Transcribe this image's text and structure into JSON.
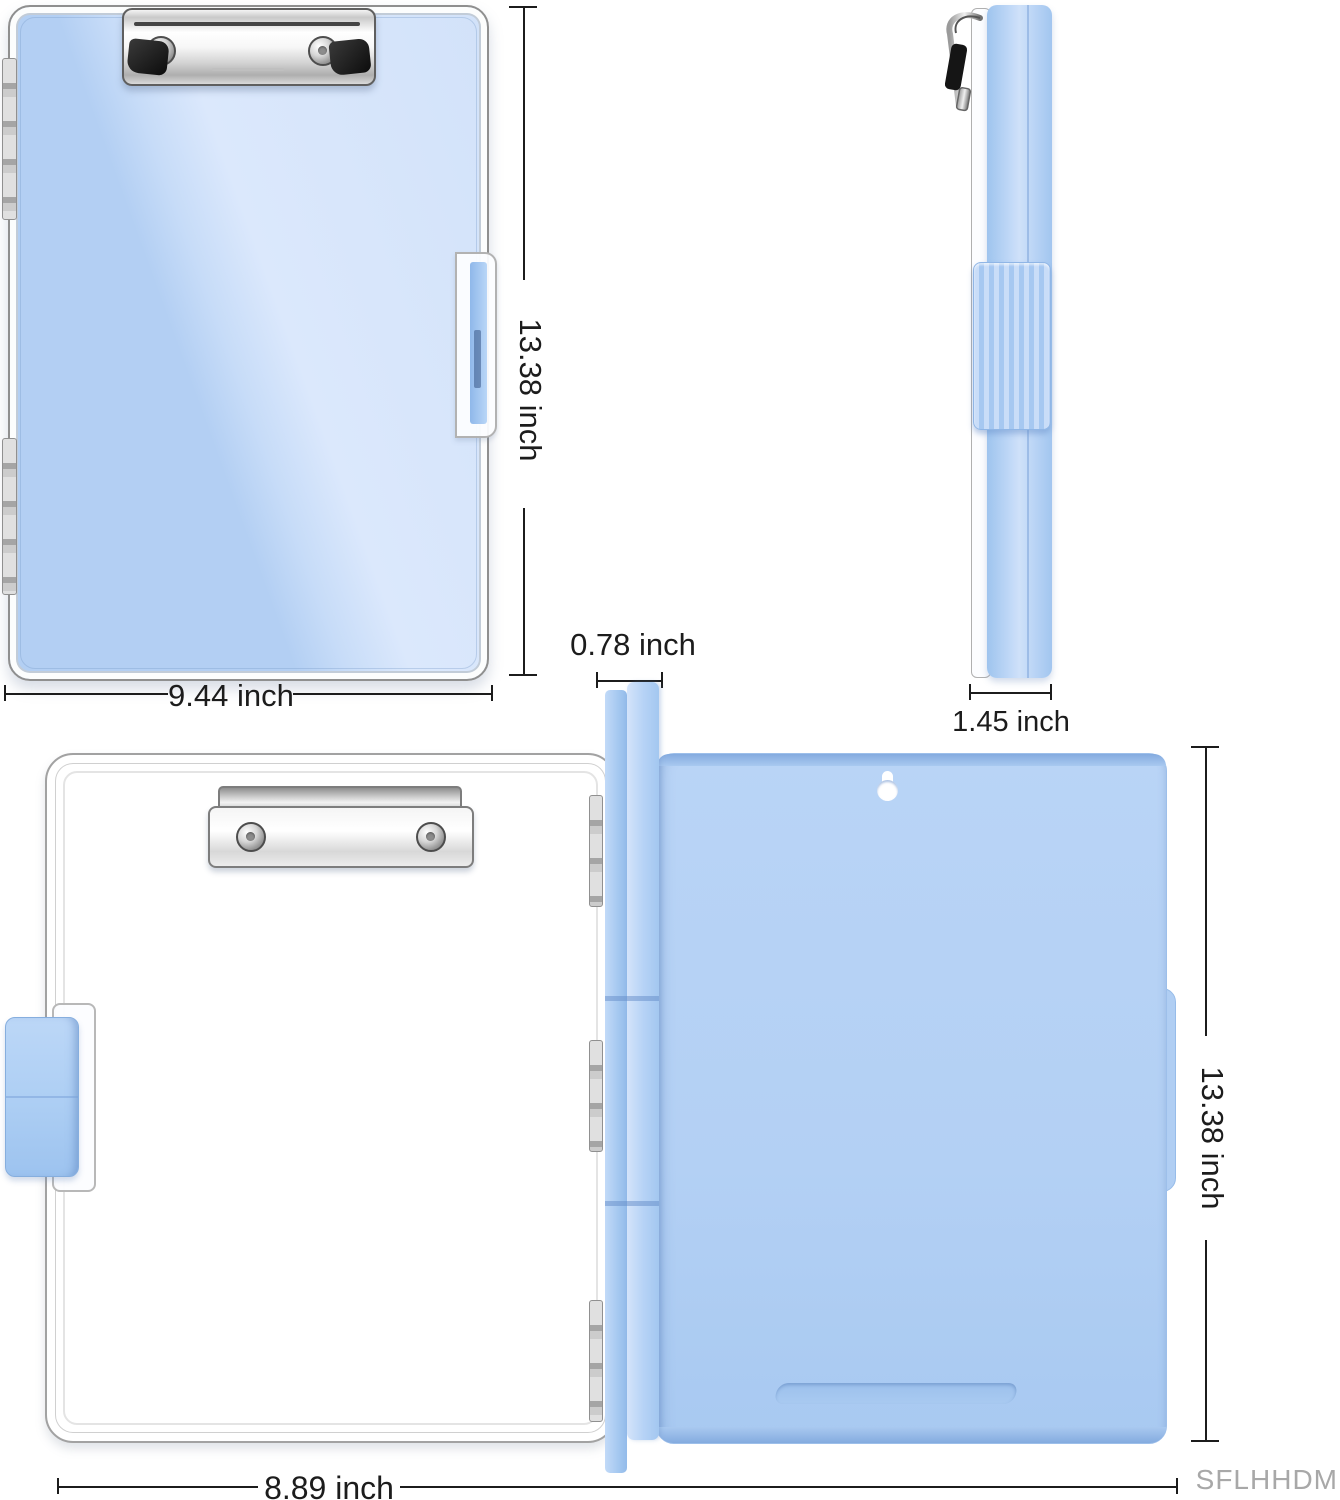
{
  "product": {
    "views": [
      "front-closed",
      "side-profile",
      "opened"
    ],
    "colors": {
      "board_blue": "#b7d2f5",
      "edge_blue": "#8fb4e6",
      "metal_silver": "#d9d9d9",
      "dimension_line": "#1c1c1c",
      "watermark_gray": "#a8a8a8"
    }
  },
  "annotations": {
    "front_height": "13.38 inch",
    "front_width": "9.44 inch",
    "side_depth": "1.45 inch",
    "spine_depth": "0.78 inch",
    "open_height": "13.38 inch",
    "open_width": "8.89 inch",
    "watermark": "SFLHHDM"
  }
}
